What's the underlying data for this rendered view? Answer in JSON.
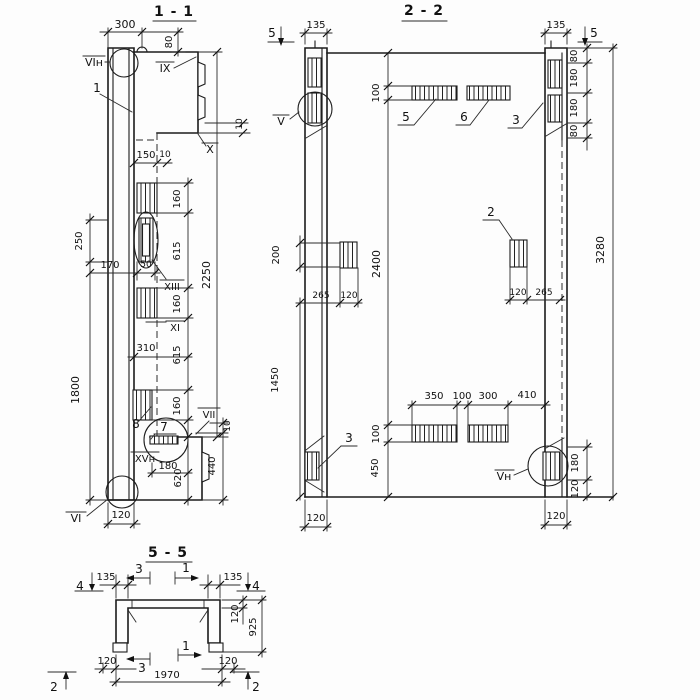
{
  "section_1_1": {
    "title": "1 - 1",
    "callouts": {
      "top_end": "VIн",
      "panel": "1",
      "notch_top": "IX",
      "notch_mid": "X",
      "slot": "XIII",
      "cut_xi": "XI",
      "block": "8",
      "detail": "7",
      "weld": "VII",
      "plate": "XVн",
      "bottom_end": "VI"
    },
    "dims": {
      "top_width": "300",
      "top_drop": "80",
      "step_a": "150",
      "step_b": "10",
      "notch_offset": "10",
      "right_chain": [
        "160",
        "615",
        "160",
        "615",
        "160"
      ],
      "overall_right": "2250",
      "left_top": "250",
      "slot_offset": "170",
      "slot_width": "50",
      "mid_width": "310",
      "left_overall": "1800",
      "foot_width": "180",
      "foot_height": "620",
      "corbel_height": "440",
      "corbel_step": "10",
      "bottom_width": "120"
    }
  },
  "section_2_2": {
    "title": "2 - 2",
    "cut_markers": {
      "left_top": "5",
      "right_top": "5"
    },
    "callouts": {
      "left_block": "V",
      "bar_a": "5",
      "bar_b": "6",
      "right_blocks": "3",
      "mid_block": "2",
      "bottom_left_block": "3",
      "bottom_right_block": "Vн"
    },
    "dims": {
      "left_col_width": "135",
      "right_col_width": "135",
      "right_chain_top": [
        "80",
        "180",
        "180",
        "80"
      ],
      "bar_height_top": "100",
      "left_offset": "200",
      "inner_height": "2400",
      "overall_height": "3280",
      "left_lower": "1450",
      "left_block": [
        "265",
        "120"
      ],
      "right_block": [
        "120",
        "265"
      ],
      "bottom_span": [
        "350",
        "100",
        "300",
        "410"
      ],
      "bar_height_bottom": "100",
      "bottom_rise": "450",
      "right_chain_bottom": [
        "180",
        "120"
      ],
      "bottom_left": "120",
      "bottom_right": "120"
    }
  },
  "section_5_5": {
    "title": "5 - 5",
    "cut_markers": {
      "left_down": "4",
      "right_down": "4",
      "top_left": "3",
      "top_right": "1",
      "bottom_left": "3",
      "bottom_right": "1",
      "bottom_up_left": "2",
      "bottom_up_right": "2"
    },
    "dims": {
      "flange_left": "135",
      "flange_right": "135",
      "slab_thickness": "120",
      "height": "925",
      "leg_left": "120",
      "span": "1970",
      "leg_right": "120"
    }
  }
}
